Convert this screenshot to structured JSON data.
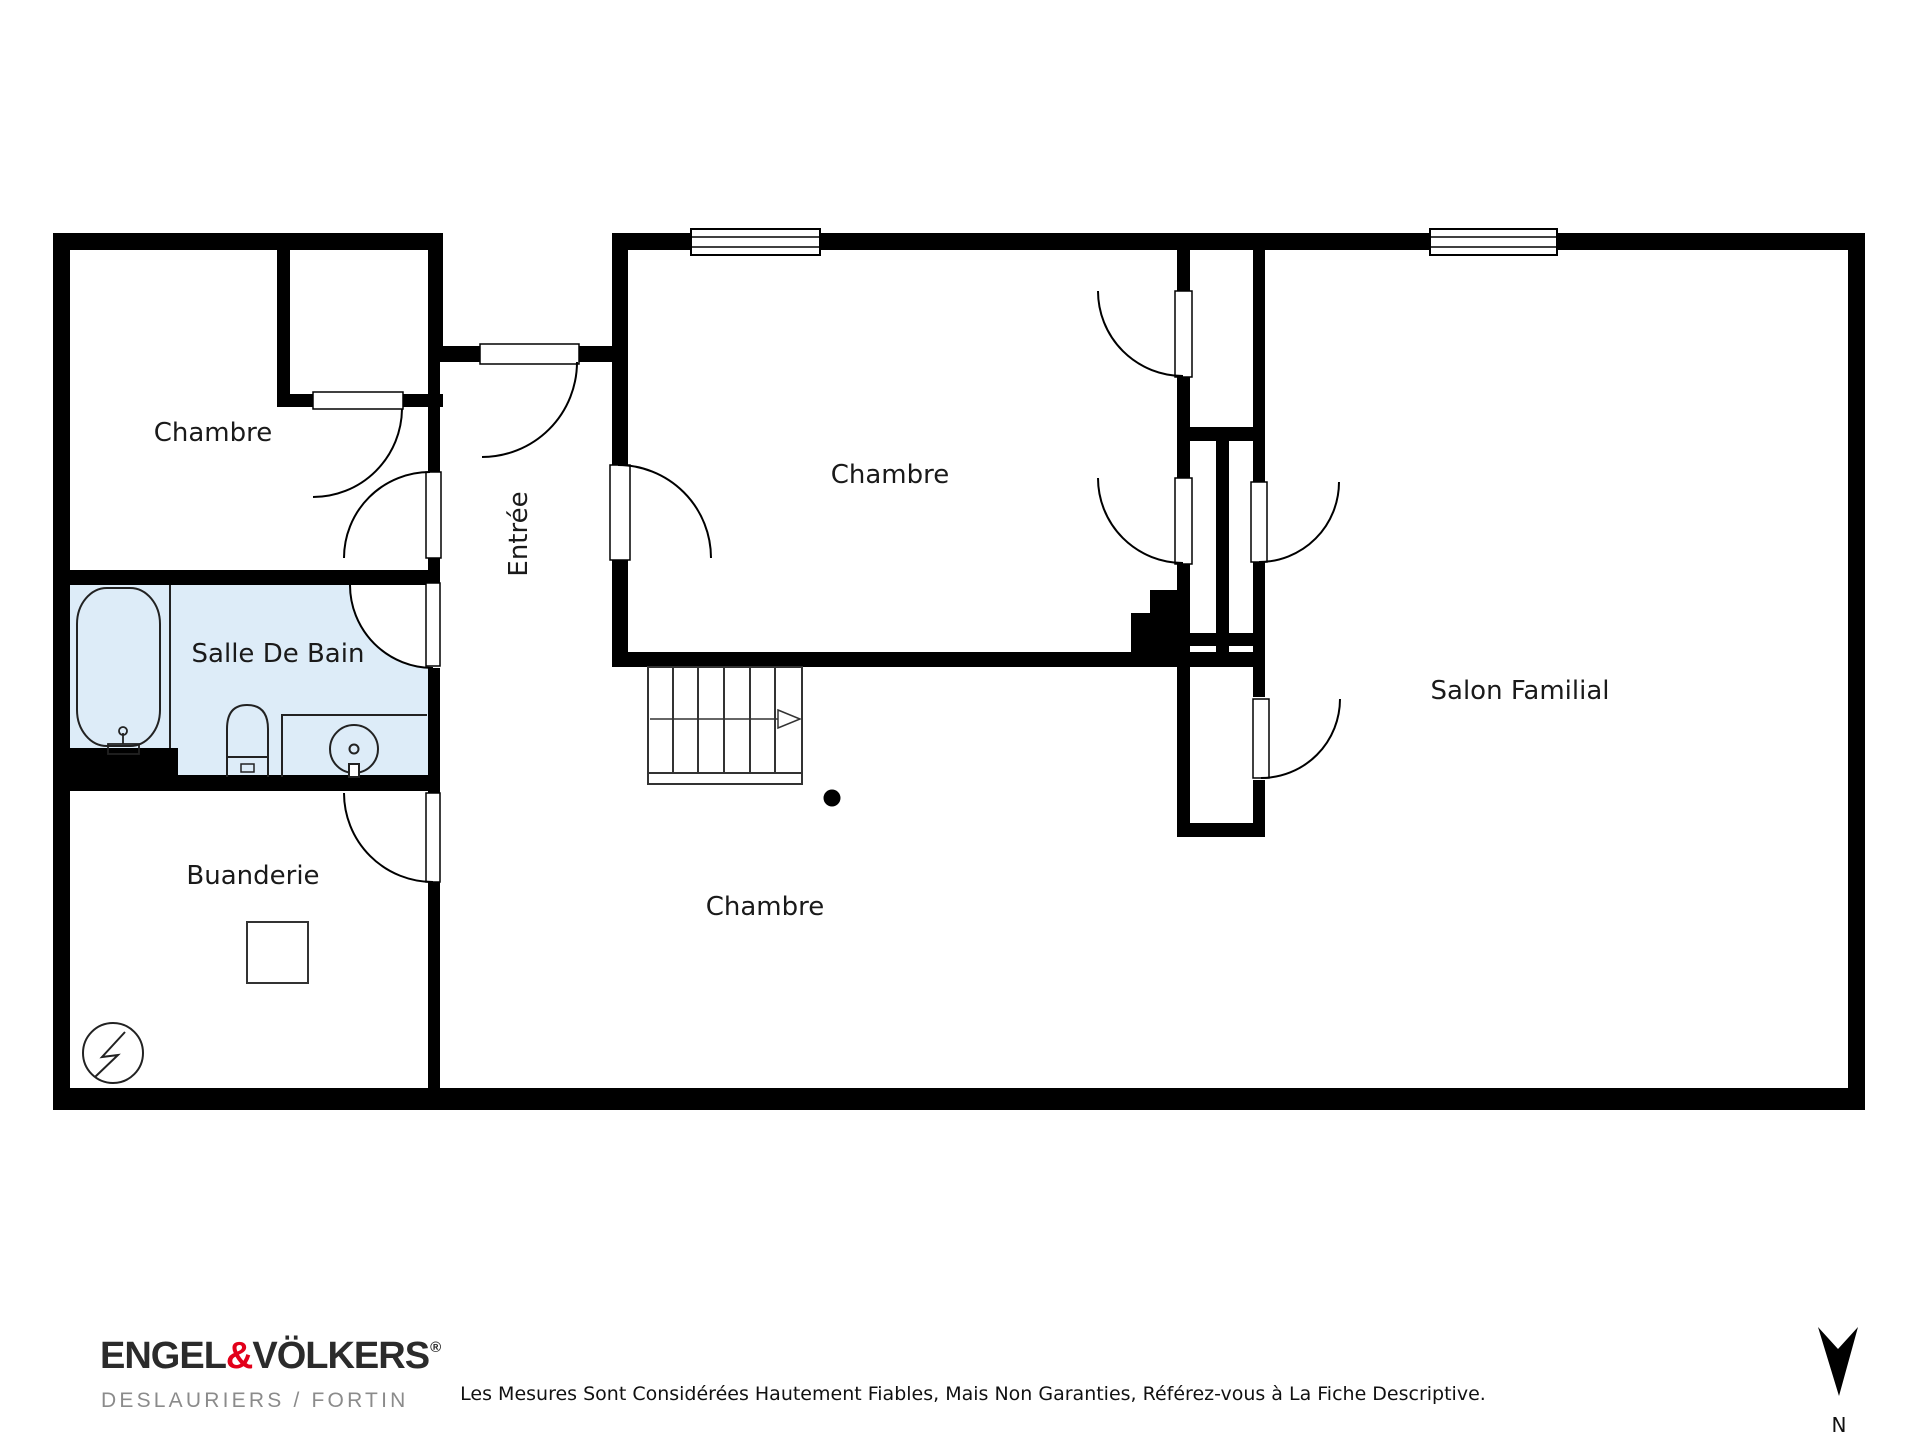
{
  "rooms": {
    "chambre_top_left": {
      "label": "Chambre"
    },
    "salle_de_bain": {
      "label": "Salle De Bain"
    },
    "buanderie": {
      "label": "Buanderie"
    },
    "entree": {
      "label": "Entrée"
    },
    "chambre_middle": {
      "label": "Chambre"
    },
    "salon_familial": {
      "label": "Salon Familial"
    },
    "chambre_bottom": {
      "label": "Chambre"
    }
  },
  "compass": {
    "north_label": "N"
  },
  "footer": {
    "brand": {
      "part1": "ENGEL",
      "amp": "&",
      "part2": "VÖLKERS",
      "registered": "®",
      "subtitle": "DESLAURIERS / FORTIN"
    },
    "disclaimer": "Les Mesures Sont Considérées Hautement Fiables, Mais Non Garanties, Référez-vous à La Fiche Descriptive."
  },
  "colors": {
    "wall": "#000000",
    "bathroom_fill": "#ddecf8",
    "brand_red": "#e2001a",
    "subtitle_gray": "#8b8b8b"
  }
}
